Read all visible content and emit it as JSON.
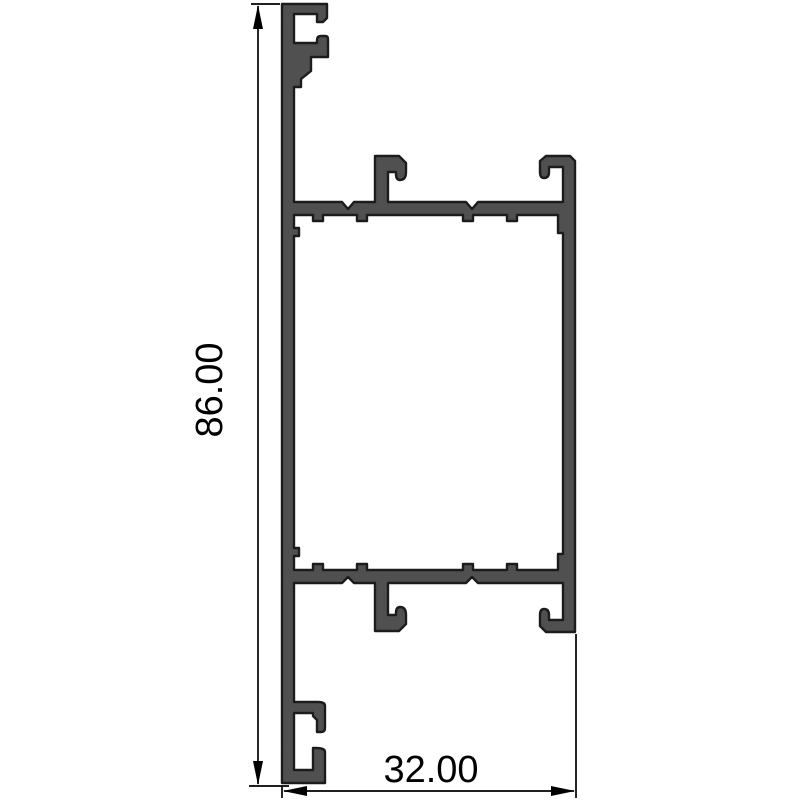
{
  "drawing": {
    "kind": "profile-cross-section"
  },
  "dimensions": {
    "height": {
      "label": "86.00"
    },
    "width": {
      "label": "32.00"
    }
  },
  "colors": {
    "background": "#ffffff",
    "profile_fill": "#505050",
    "profile_outline": "#1c1c1c",
    "dimension_color": "#000000"
  }
}
